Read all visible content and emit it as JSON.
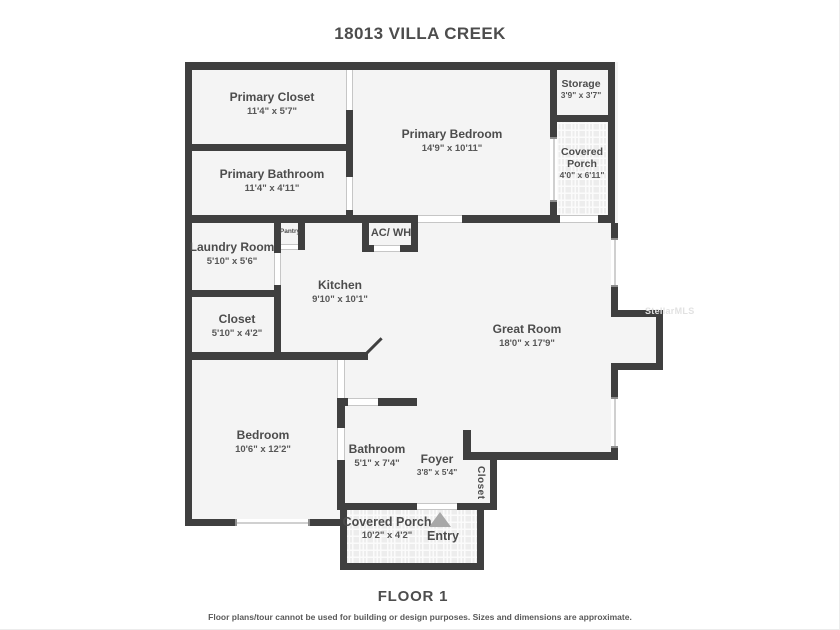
{
  "title": "18013 VILLA CREEK",
  "floor_label": "FLOOR 1",
  "disclaimer": "Floor plans/tour cannot be used for building or design purposes. Sizes and dimensions are approximate.",
  "watermark": "StellarMLS",
  "rooms": {
    "primary_closet": {
      "name": "Primary Closet",
      "dims": "11'4\" x 5'7\""
    },
    "primary_bathroom": {
      "name": "Primary Bathroom",
      "dims": "11'4\" x 4'11\""
    },
    "primary_bedroom": {
      "name": "Primary Bedroom",
      "dims": "14'9\" x 10'11\""
    },
    "storage": {
      "name": "Storage",
      "dims": "3'9\" x 3'7\""
    },
    "covered_porch_upper": {
      "name": "Covered Porch",
      "dims": "4'0\" x 6'11\""
    },
    "laundry_room": {
      "name": "Laundry Room",
      "dims": "5'10\" x 5'6\""
    },
    "kitchen": {
      "name": "Kitchen",
      "dims": "9'10\" x 10'1\""
    },
    "hall_closet": {
      "name": "Closet",
      "dims": "5'10\" x 4'2\""
    },
    "great_room": {
      "name": "Great Room",
      "dims": "18'0\" x 17'9\""
    },
    "bedroom": {
      "name": "Bedroom",
      "dims": "10'6\" x 12'2\""
    },
    "bathroom": {
      "name": "Bathroom",
      "dims": "5'1\" x 7'4\""
    },
    "foyer": {
      "name": "Foyer",
      "dims": "3'8\" x 5'4\""
    },
    "covered_porch_lower": {
      "name": "Covered Porch",
      "dims": "10'2\" x 4'2\""
    }
  },
  "labels": {
    "pantry": "Pantry",
    "ac_wh": "AC/ WH",
    "entry": "Entry",
    "entry_closet": "Closet"
  },
  "colors": {
    "wall": "#3f3f3f",
    "floor": "#f4f4f4",
    "porch_floor": "#ededed",
    "text": "#4c4c4c",
    "entry_arrow": "#a8a8a8",
    "watermark": "#e2e2e2"
  }
}
